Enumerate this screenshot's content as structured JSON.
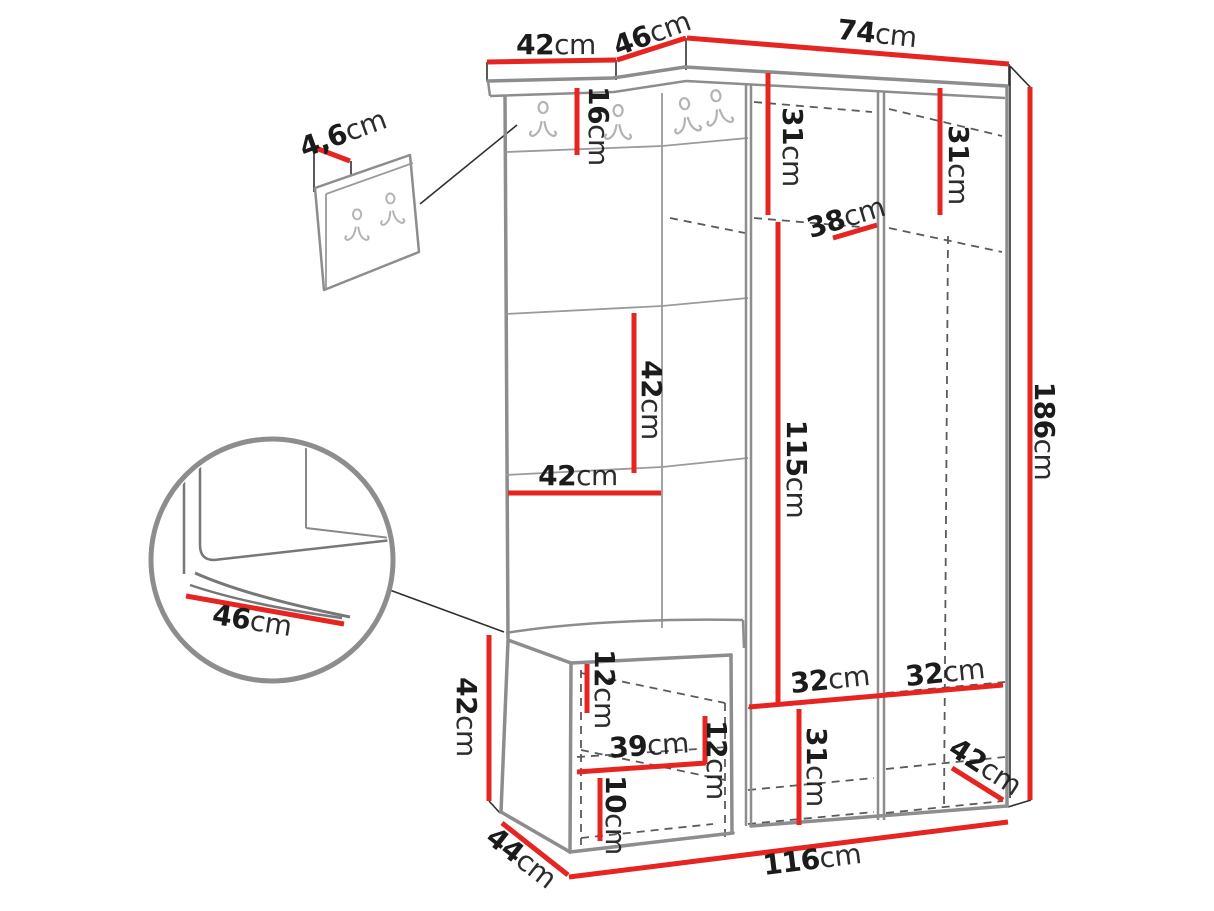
{
  "diagram": {
    "type": "furniture-dimension-diagram",
    "colors": {
      "dim": "#e62420",
      "outline": "#8d8d8d",
      "outline_light": "#9a9a9a",
      "thin": "#2f2f2f",
      "dash": "#5a5a5a",
      "hook": "#b3b3b3",
      "text": "#1b1b1b",
      "bg": "#ffffff"
    },
    "dims": {
      "panel_top_width": {
        "value": "42",
        "unit": "cm"
      },
      "corner_top_width": {
        "value": "46",
        "unit": "cm"
      },
      "wardrobe_top_width": {
        "value": "74",
        "unit": "cm"
      },
      "wall_panel_depth": {
        "value": "4,6",
        "unit": "cm"
      },
      "hook_rail_height": {
        "value": "16",
        "unit": "cm"
      },
      "left_door_top_height": {
        "value": "31",
        "unit": "cm"
      },
      "right_door_top_height": {
        "value": "31",
        "unit": "cm"
      },
      "shelf_depth": {
        "value": "38",
        "unit": "cm"
      },
      "panel_segment_height": {
        "value": "42",
        "unit": "cm"
      },
      "panel_width": {
        "value": "42",
        "unit": "cm"
      },
      "door_height": {
        "value": "115",
        "unit": "cm"
      },
      "total_height": {
        "value": "186",
        "unit": "cm"
      },
      "seat_depth_detail": {
        "value": "46",
        "unit": "cm"
      },
      "bench_height": {
        "value": "42",
        "unit": "cm"
      },
      "bench_top_gap": {
        "value": "12",
        "unit": "cm"
      },
      "bench_inner_width": {
        "value": "39",
        "unit": "cm"
      },
      "bench_shelf_gap": {
        "value": "12",
        "unit": "cm"
      },
      "bench_bottom_gap": {
        "value": "10",
        "unit": "cm"
      },
      "left_bottom_width": {
        "value": "32",
        "unit": "cm"
      },
      "right_bottom_width": {
        "value": "32",
        "unit": "cm"
      },
      "bottom_drawer_height": {
        "value": "31",
        "unit": "cm"
      },
      "wardrobe_depth": {
        "value": "42",
        "unit": "cm"
      },
      "bench_depth": {
        "value": "44",
        "unit": "cm"
      },
      "total_width": {
        "value": "116",
        "unit": "cm"
      }
    }
  }
}
